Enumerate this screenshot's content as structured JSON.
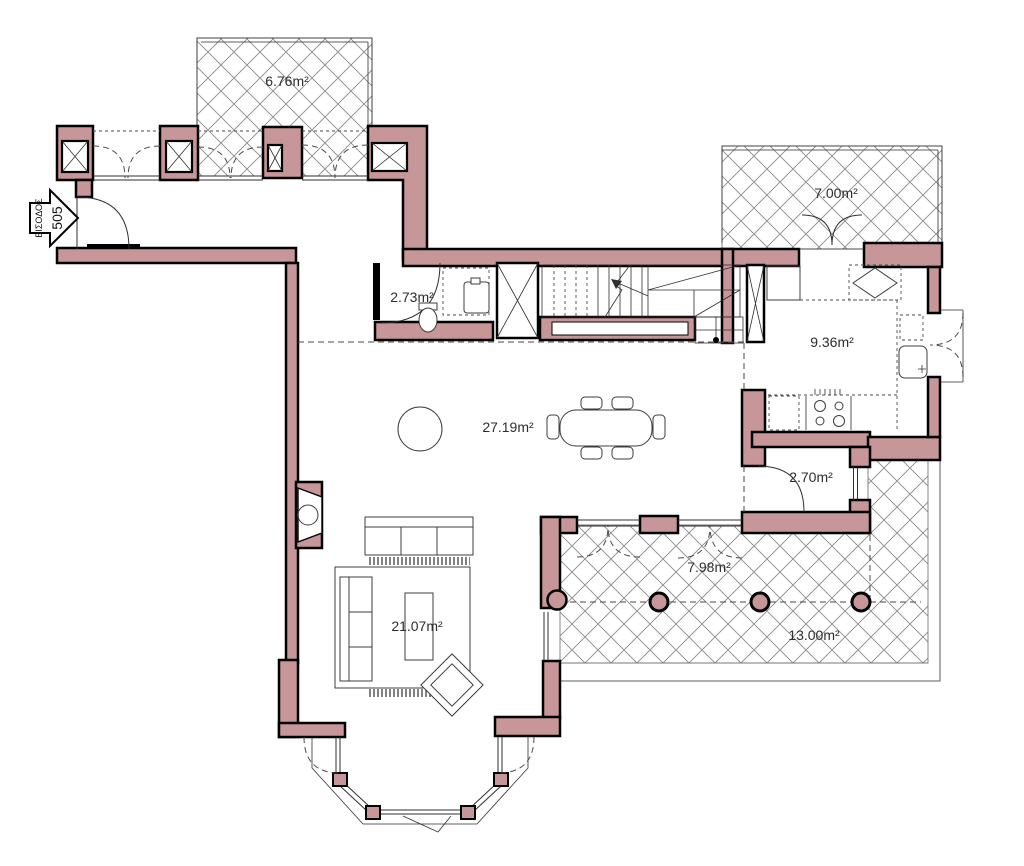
{
  "plan": {
    "entrance": {
      "label": "ΕΙΣΟΔΟΣ",
      "number": "505"
    },
    "rooms": [
      {
        "name": "balcony-top",
        "area_label": "6.76m²"
      },
      {
        "name": "balcony-kitchen",
        "area_label": "7.00m²"
      },
      {
        "name": "wc",
        "area_label": "2.73m²"
      },
      {
        "name": "kitchen",
        "area_label": "9.36m²"
      },
      {
        "name": "living-dining",
        "area_label": "27.19m²"
      },
      {
        "name": "storage",
        "area_label": "2.70m²"
      },
      {
        "name": "veranda-front",
        "area_label": "7.98m²"
      },
      {
        "name": "veranda-side",
        "area_label": "13.00m²"
      },
      {
        "name": "sitting-area",
        "area_label": "21.07m²"
      }
    ],
    "colors": {
      "wall_fill": "#c79698",
      "wall_outline": "#000000",
      "line": "#2f2f2f",
      "hatch_line": "#8a8a8a",
      "background": "#ffffff"
    }
  }
}
